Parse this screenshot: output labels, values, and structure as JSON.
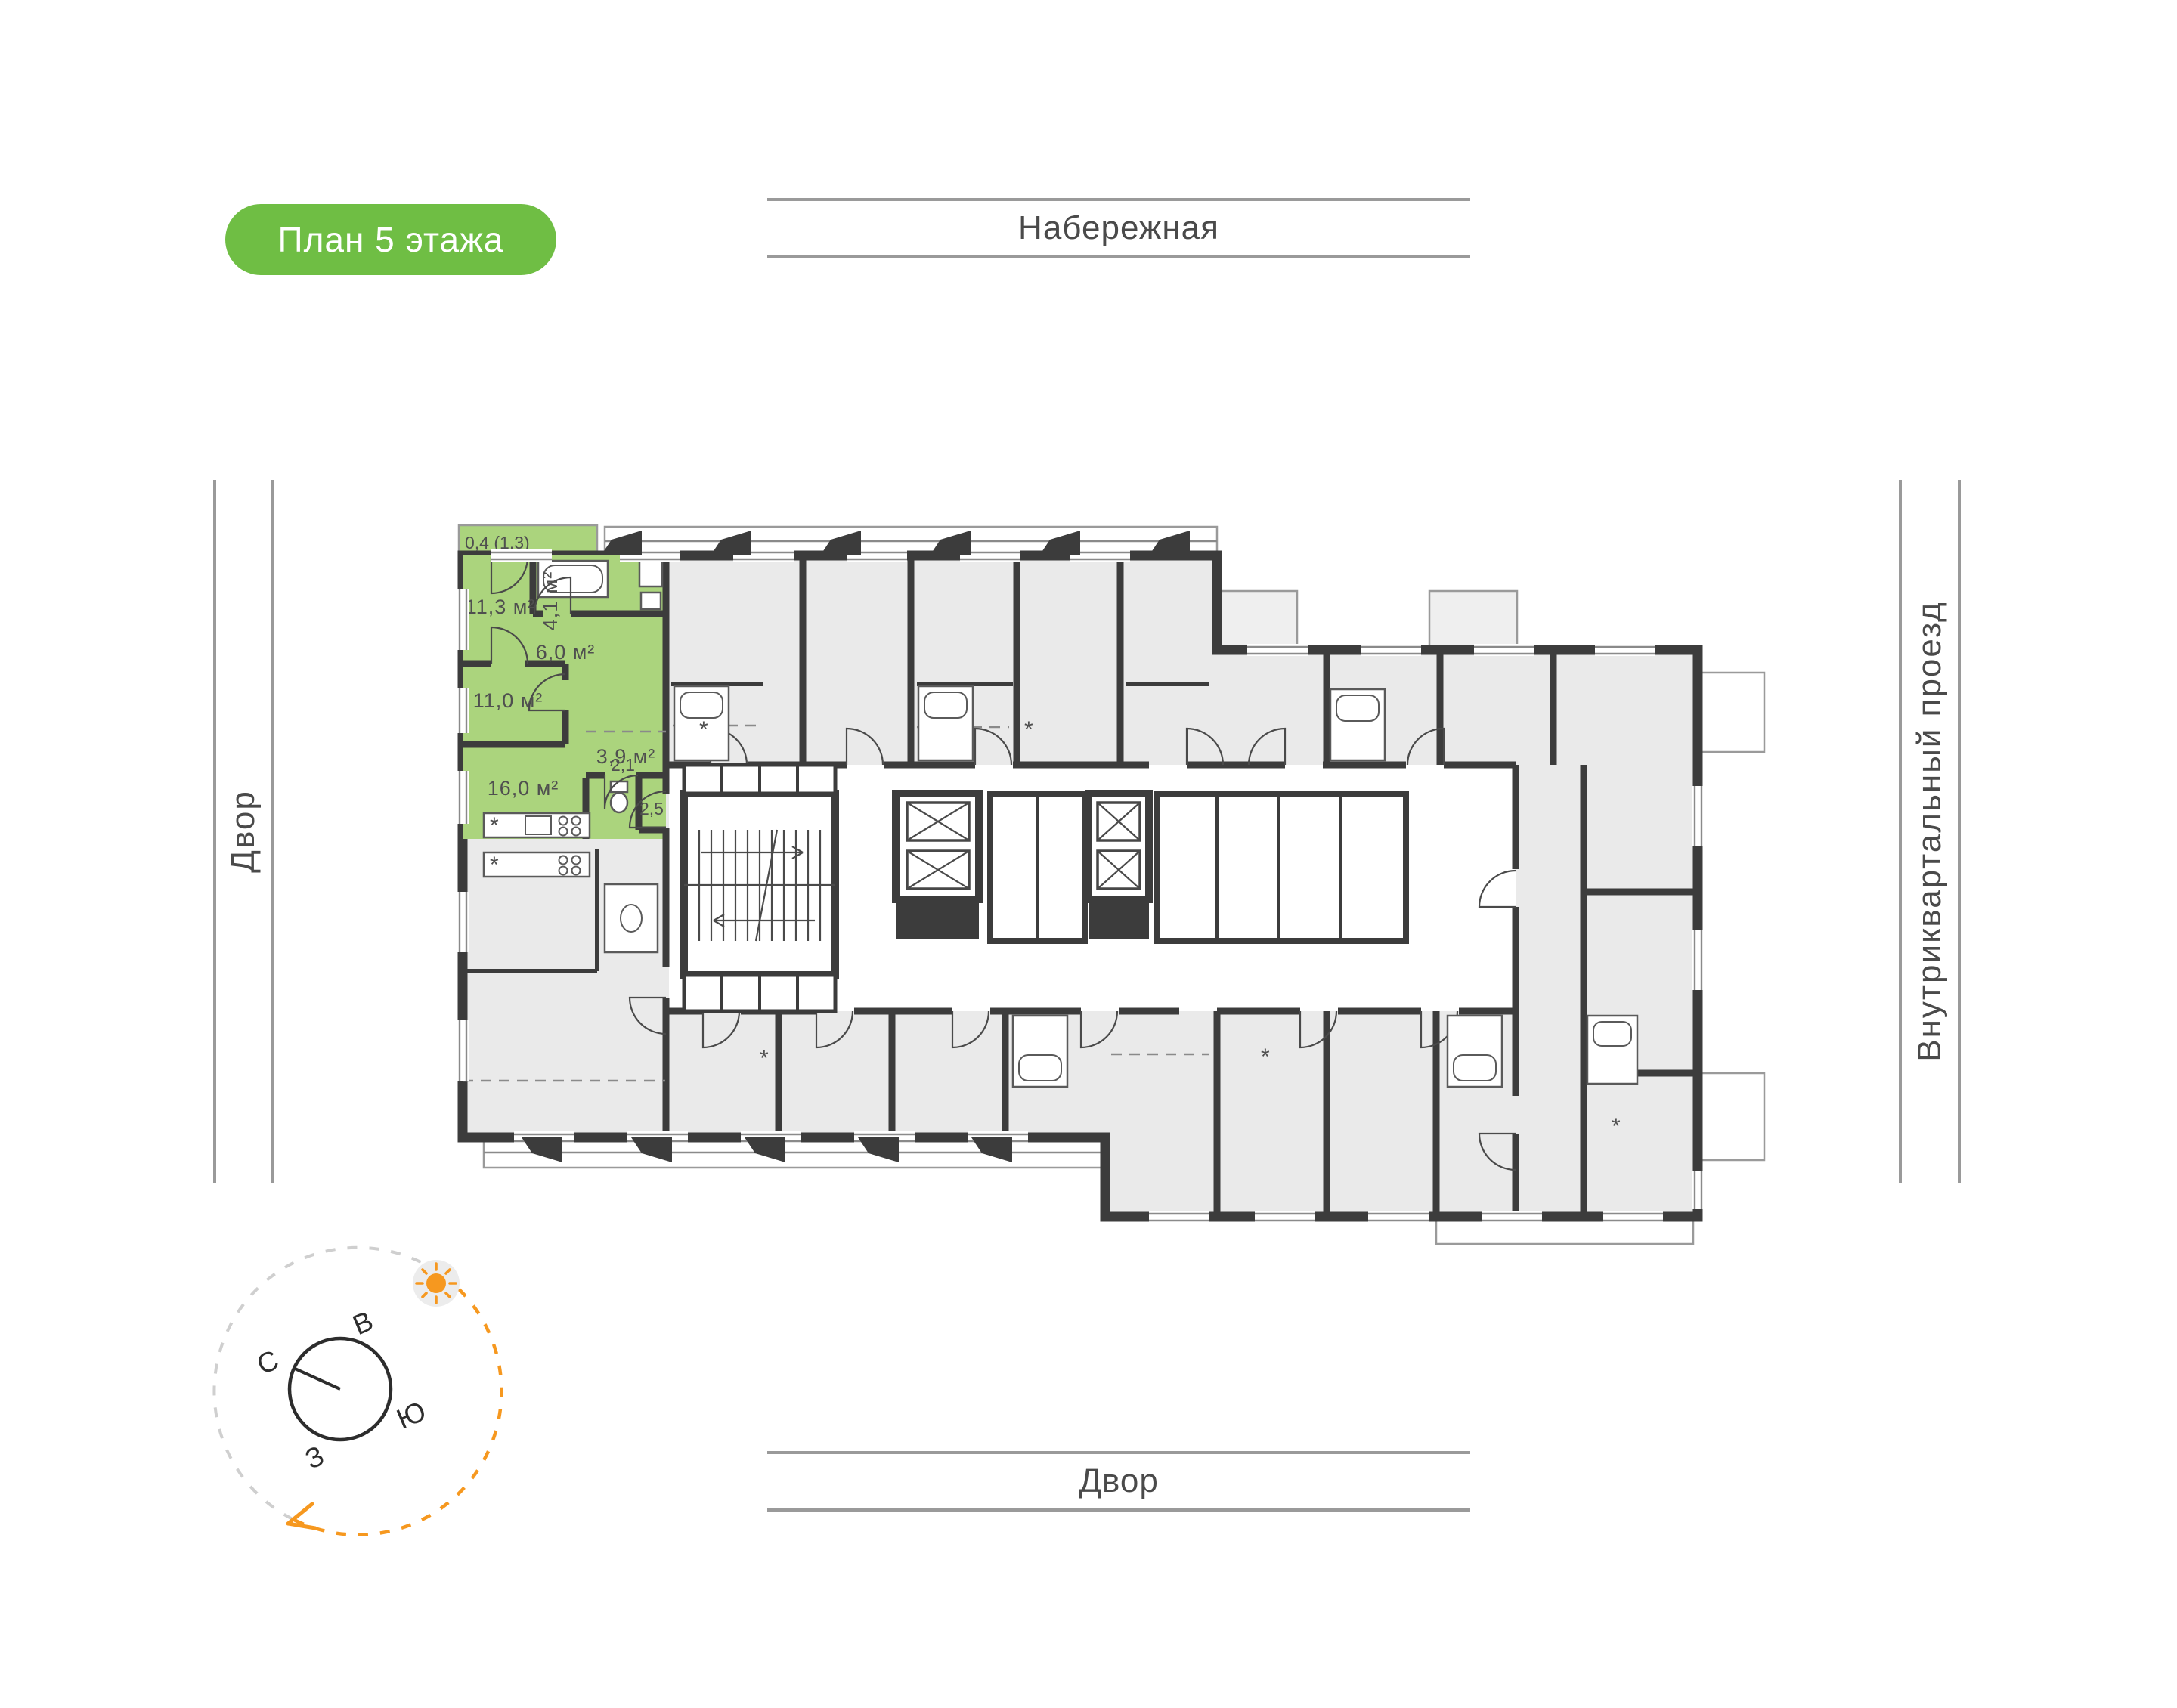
{
  "page": {
    "title_badge": "План 5 этажа"
  },
  "streets": {
    "top": "Набережная",
    "bottom": "Двор",
    "left": "Двор",
    "right": "Внутриквартальный проезд"
  },
  "apartment": {
    "highlight_color": "#abd47d",
    "balcony": {
      "label": "0,4 (1,3)"
    },
    "rooms": [
      {
        "name": "bedroom-1",
        "label": "11,3 м²"
      },
      {
        "name": "bathroom",
        "label": "4,1 м²"
      },
      {
        "name": "hallway",
        "label": "6,0 м²"
      },
      {
        "name": "bedroom-2",
        "label": "11,0 м²"
      },
      {
        "name": "hall",
        "label": "3,9 м²"
      },
      {
        "name": "kitchen-living",
        "label": "16,0 м²"
      },
      {
        "name": "wc",
        "label": "2,1"
      },
      {
        "name": "entry",
        "label": "2,5"
      }
    ]
  },
  "compass": {
    "north": "С",
    "east": "В",
    "south": "Ю",
    "west": "З"
  },
  "colors": {
    "badge_green": "#6fbe44",
    "apartment_green": "#abd47d",
    "wall": "#3c3c3c",
    "room_fill": "#eaeaea",
    "accent_orange": "#f6981f",
    "street_line": "#9a9a9a",
    "text_gray": "#4a4a4a"
  }
}
